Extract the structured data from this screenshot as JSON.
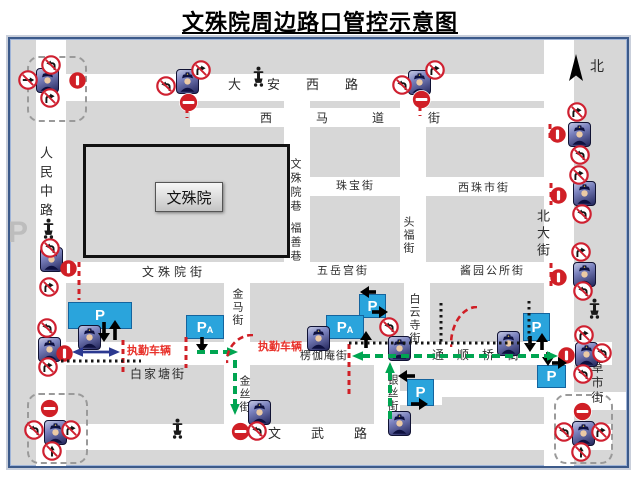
{
  "title": "文殊院周边路口管控示意图",
  "colors": {
    "road": "#ffffff",
    "block": "#d7d7d7",
    "prohibit_red": "#d01f26",
    "sign_ring_red": "#cf2030",
    "parking_blue": "#2aa4dc",
    "route_green": "#00a551",
    "duty_text_red": "#e8312a",
    "escort_blue": "#2b3990",
    "frame_navy": "#3c5a8a"
  },
  "map": {
    "building": {
      "label": "文殊院"
    },
    "north_label": "北",
    "streets": [
      {
        "id": "renmin-zhong-rd",
        "x": 36,
        "y": 40,
        "w": 30,
        "h": 426
      },
      {
        "id": "beida-st",
        "x": 544,
        "y": 40,
        "w": 30,
        "h": 426
      },
      {
        "id": "daan-xi-rd",
        "x": 36,
        "y": 74,
        "w": 538,
        "h": 27
      },
      {
        "id": "ximadao-st",
        "x": 190,
        "y": 108,
        "w": 366,
        "h": 19
      },
      {
        "id": "wenshuyuan-xiang",
        "x": 284,
        "y": 101,
        "w": 26,
        "h": 164
      },
      {
        "id": "toufu-st",
        "x": 400,
        "y": 101,
        "w": 26,
        "h": 164
      },
      {
        "id": "zhubao-xizhushi-st",
        "x": 310,
        "y": 177,
        "w": 235,
        "h": 19
      },
      {
        "id": "wenshuyuan-wuyuegong-jiangyuan-st",
        "x": 36,
        "y": 262,
        "w": 538,
        "h": 21
      },
      {
        "id": "jinma-st",
        "x": 224,
        "y": 283,
        "w": 26,
        "h": 61
      },
      {
        "id": "baiyunsi-st",
        "x": 404,
        "y": 283,
        "w": 26,
        "h": 61
      },
      {
        "id": "baijiatang-tongshunqiao-st",
        "x": 36,
        "y": 342,
        "w": 576,
        "h": 23
      },
      {
        "id": "jinsi-st",
        "x": 224,
        "y": 365,
        "w": 26,
        "h": 61
      },
      {
        "id": "yinsi-st",
        "x": 374,
        "y": 365,
        "w": 26,
        "h": 61
      },
      {
        "id": "wenwu-rd",
        "x": 36,
        "y": 424,
        "w": 576,
        "h": 26
      },
      {
        "id": "side-lane",
        "x": 430,
        "y": 380,
        "w": 114,
        "h": 17
      },
      {
        "id": "side-lane-2",
        "x": 400,
        "y": 391,
        "w": 42,
        "h": 14
      },
      {
        "id": "caoshi-st-stub",
        "x": 574,
        "y": 392,
        "w": 52,
        "h": 18
      }
    ],
    "clusters": [
      {
        "x": 27,
        "y": 56,
        "w": 56,
        "h": 62
      },
      {
        "x": 27,
        "y": 393,
        "w": 57,
        "h": 67
      },
      {
        "x": 554,
        "y": 394,
        "w": 55,
        "h": 66
      }
    ],
    "labels": [
      {
        "t": "人民中路",
        "x": 39,
        "y": 146,
        "v": 1,
        "s": 13,
        "ls": 6
      },
      {
        "t": "大安西路",
        "x": 228,
        "y": 78,
        "s": 13,
        "ls": 26
      },
      {
        "t": "西马道街",
        "x": 260,
        "y": 112,
        "s": 12,
        "ls": 44
      },
      {
        "t": "文殊院巷",
        "x": 289,
        "y": 158,
        "v": 1,
        "s": 11,
        "ls": 3
      },
      {
        "t": "福善巷",
        "x": 289,
        "y": 222,
        "v": 1,
        "s": 11,
        "ls": 3
      },
      {
        "t": "珠宝街",
        "x": 336,
        "y": 181,
        "s": 11,
        "ls": 2
      },
      {
        "t": "西珠市街",
        "x": 458,
        "y": 183,
        "s": 11,
        "ls": 2
      },
      {
        "t": "头福街",
        "x": 402,
        "y": 216,
        "v": 1,
        "s": 11,
        "ls": 2
      },
      {
        "t": "北大街",
        "x": 536,
        "y": 209,
        "v": 1,
        "s": 13,
        "ls": 4
      },
      {
        "t": "北",
        "x": 590,
        "y": 61,
        "s": 14,
        "name": "north-label"
      },
      {
        "t": "文殊院街",
        "x": 142,
        "y": 266,
        "s": 12,
        "ls": 4
      },
      {
        "t": "五岳宫街",
        "x": 317,
        "y": 266,
        "s": 11,
        "ls": 2
      },
      {
        "t": "酱园公所街",
        "x": 460,
        "y": 266,
        "s": 11,
        "ls": 2
      },
      {
        "t": "金马街",
        "x": 231,
        "y": 288,
        "v": 1,
        "s": 11,
        "ls": 2
      },
      {
        "t": "白云寺街",
        "x": 408,
        "y": 293,
        "v": 1,
        "s": 11,
        "ls": 2
      },
      {
        "t": "执勤车辆",
        "x": 127,
        "y": 346,
        "s": 11,
        "c": "#e8312a",
        "b": 1,
        "name": "duty-vehicle-label"
      },
      {
        "t": "执勤车辆",
        "x": 258,
        "y": 342,
        "s": 11,
        "c": "#e8312a",
        "b": 1,
        "name": "duty-vehicle-label"
      },
      {
        "t": "楞伽庵街",
        "x": 300,
        "y": 351,
        "s": 11,
        "ls": 1
      },
      {
        "t": "白家塘街",
        "x": 130,
        "y": 368,
        "s": 12,
        "ls": 2
      },
      {
        "t": "通顺桥街",
        "x": 432,
        "y": 349,
        "s": 12,
        "ls": 13
      },
      {
        "t": "金丝街",
        "x": 238,
        "y": 375,
        "v": 1,
        "s": 11,
        "ls": 2
      },
      {
        "t": "银丝街",
        "x": 386,
        "y": 374,
        "v": 1,
        "s": 11,
        "ls": 2
      },
      {
        "t": "草市街",
        "x": 591,
        "y": 361,
        "v": 1,
        "s": 12,
        "ls": 3
      },
      {
        "t": "文武路",
        "x": 268,
        "y": 427,
        "s": 13,
        "ls": 30
      },
      {
        "t": "P",
        "x": 8,
        "y": 218,
        "s": 30,
        "c": "#bdbdbd",
        "b": 1,
        "f": "sans",
        "name": "parking-watermark"
      }
    ],
    "markers": [
      {
        "t": "police-icon",
        "x": 46,
        "y": 79
      },
      {
        "t": "police-icon",
        "x": 186,
        "y": 80
      },
      {
        "t": "police-icon",
        "x": 418,
        "y": 81
      },
      {
        "t": "police-icon",
        "x": 578,
        "y": 133
      },
      {
        "t": "police-icon",
        "x": 583,
        "y": 192
      },
      {
        "t": "police-icon",
        "x": 583,
        "y": 273
      },
      {
        "t": "police-icon",
        "x": 50,
        "y": 258
      },
      {
        "t": "police-icon",
        "x": 88,
        "y": 336
      },
      {
        "t": "police-icon",
        "x": 48,
        "y": 348
      },
      {
        "t": "police-icon",
        "x": 317,
        "y": 337
      },
      {
        "t": "police-icon",
        "x": 398,
        "y": 347
      },
      {
        "t": "police-icon",
        "x": 507,
        "y": 342
      },
      {
        "t": "police-icon",
        "x": 585,
        "y": 353
      },
      {
        "t": "police-icon",
        "x": 258,
        "y": 411
      },
      {
        "t": "police-icon",
        "x": 398,
        "y": 422
      },
      {
        "t": "police-icon",
        "x": 54,
        "y": 431
      },
      {
        "t": "police-icon",
        "x": 582,
        "y": 432
      },
      {
        "t": "checkpoint-sign",
        "x": 77,
        "y": 80
      },
      {
        "t": "checkpoint-sign",
        "x": 68,
        "y": 268
      },
      {
        "t": "checkpoint-sign",
        "x": 64,
        "y": 353
      },
      {
        "t": "checkpoint-sign",
        "x": 557,
        "y": 134
      },
      {
        "t": "checkpoint-sign",
        "x": 558,
        "y": 195
      },
      {
        "t": "checkpoint-sign",
        "x": 558,
        "y": 277
      },
      {
        "t": "checkpoint-sign",
        "x": 566,
        "y": 355
      },
      {
        "t": "no-entry-sign",
        "x": 188,
        "y": 102
      },
      {
        "t": "no-entry-sign",
        "x": 421,
        "y": 99
      },
      {
        "t": "no-entry-sign",
        "x": 49,
        "y": 408
      },
      {
        "t": "no-entry-sign",
        "x": 240,
        "y": 431
      },
      {
        "t": "no-entry-sign",
        "x": 582,
        "y": 411
      },
      {
        "t": "no-left-turn-sign",
        "x": 51,
        "y": 65
      },
      {
        "t": "no-left-turn-sign",
        "x": 166,
        "y": 86
      },
      {
        "t": "no-left-turn-sign",
        "x": 402,
        "y": 85
      },
      {
        "t": "no-left-turn-sign",
        "x": 580,
        "y": 155
      },
      {
        "t": "no-left-turn-sign",
        "x": 582,
        "y": 214
      },
      {
        "t": "no-left-turn-sign",
        "x": 583,
        "y": 291
      },
      {
        "t": "no-left-turn-sign",
        "x": 50,
        "y": 248
      },
      {
        "t": "no-left-turn-sign",
        "x": 47,
        "y": 328
      },
      {
        "t": "no-left-turn-sign",
        "x": 34,
        "y": 430
      },
      {
        "t": "no-left-turn-sign",
        "x": 564,
        "y": 432
      },
      {
        "t": "no-left-turn-sign",
        "x": 389,
        "y": 327
      },
      {
        "t": "no-left-turn-sign",
        "x": 583,
        "y": 374
      },
      {
        "t": "no-left-turn-sign",
        "x": 257,
        "y": 431
      },
      {
        "t": "no-left-turn-sign",
        "x": 602,
        "y": 353
      },
      {
        "t": "no-right-turn-sign",
        "x": 50,
        "y": 98
      },
      {
        "t": "no-right-turn-sign",
        "x": 201,
        "y": 70
      },
      {
        "t": "no-right-turn-sign",
        "x": 435,
        "y": 70
      },
      {
        "t": "no-right-turn-sign",
        "x": 577,
        "y": 112
      },
      {
        "t": "no-right-turn-sign",
        "x": 579,
        "y": 175
      },
      {
        "t": "no-right-turn-sign",
        "x": 581,
        "y": 252
      },
      {
        "t": "no-right-turn-sign",
        "x": 49,
        "y": 287
      },
      {
        "t": "no-right-turn-sign",
        "x": 48,
        "y": 367
      },
      {
        "t": "no-right-turn-sign",
        "x": 71,
        "y": 430
      },
      {
        "t": "no-right-turn-sign",
        "x": 601,
        "y": 432
      },
      {
        "t": "no-right-turn-sign",
        "x": 584,
        "y": 335
      },
      {
        "t": "no-straight-sign",
        "x": 52,
        "y": 451
      },
      {
        "t": "no-straight-sign",
        "x": 581,
        "y": 452
      },
      {
        "t": "no-through-sign",
        "x": 28,
        "y": 80
      },
      {
        "t": "motorcycle-icon",
        "x": 258,
        "y": 76
      },
      {
        "t": "motorcycle-icon",
        "x": 48,
        "y": 228
      },
      {
        "t": "motorcycle-icon",
        "x": 594,
        "y": 308
      },
      {
        "t": "motorcycle-icon",
        "x": 177,
        "y": 428
      },
      {
        "t": "north-arrow-icon",
        "x": 576,
        "y": 70
      }
    ],
    "arrows": [
      {
        "x": 98,
        "y": 322,
        "d": "down",
        "l": 20
      },
      {
        "x": 109,
        "y": 320,
        "d": "up",
        "l": 20
      },
      {
        "x": 196,
        "y": 337,
        "d": "down",
        "l": 16
      },
      {
        "x": 360,
        "y": 331,
        "d": "up",
        "l": 17
      },
      {
        "x": 360,
        "y": 286,
        "d": "left",
        "l": 16
      },
      {
        "x": 372,
        "y": 306,
        "d": "right",
        "l": 16
      },
      {
        "x": 524,
        "y": 336,
        "d": "down",
        "l": 16
      },
      {
        "x": 536,
        "y": 333,
        "d": "up",
        "l": 17
      },
      {
        "x": 542,
        "y": 352,
        "d": "down",
        "l": 14
      },
      {
        "x": 398,
        "y": 370,
        "d": "left",
        "l": 17
      },
      {
        "x": 411,
        "y": 398,
        "d": "right",
        "l": 17
      },
      {
        "x": 552,
        "y": 357,
        "d": "right",
        "l": 15
      }
    ],
    "lines": [
      {
        "k": "red",
        "o": "v",
        "x": 187,
        "y": 107,
        "l": 12
      },
      {
        "k": "red",
        "o": "v",
        "x": 420,
        "y": 105,
        "l": 12
      },
      {
        "k": "red",
        "o": "v",
        "x": 550,
        "y": 123,
        "l": 20
      },
      {
        "k": "red",
        "o": "v",
        "x": 551,
        "y": 182,
        "l": 24
      },
      {
        "k": "red",
        "o": "v",
        "x": 551,
        "y": 262,
        "l": 27
      },
      {
        "k": "red",
        "o": "v",
        "x": 79,
        "y": 261,
        "l": 40
      },
      {
        "k": "red",
        "o": "v",
        "x": 123,
        "y": 339,
        "l": 34
      },
      {
        "k": "red",
        "o": "v",
        "x": 186,
        "y": 336,
        "l": 33
      },
      {
        "k": "red",
        "o": "v",
        "x": 349,
        "y": 343,
        "l": 56
      },
      {
        "k": "green",
        "o": "h",
        "x": 196,
        "y": 352,
        "l": 42,
        "he": 1
      },
      {
        "k": "green",
        "o": "v",
        "x": 235,
        "y": 359,
        "l": 56,
        "he": 1
      },
      {
        "k": "green",
        "o": "h",
        "x": 352,
        "y": 356,
        "l": 206,
        "hs": 1,
        "he": 1
      },
      {
        "k": "green",
        "o": "v",
        "x": 390,
        "y": 362,
        "l": 62,
        "hs": 1
      },
      {
        "k": "dot",
        "o": "h",
        "x": 60,
        "y": 361,
        "l": 82
      },
      {
        "k": "dot",
        "o": "h",
        "x": 348,
        "y": 343,
        "l": 176
      },
      {
        "k": "dot",
        "o": "v",
        "x": 441,
        "y": 302,
        "l": 42
      },
      {
        "k": "dot",
        "o": "v",
        "x": 529,
        "y": 300,
        "l": 46
      },
      {
        "k": "blue",
        "o": "h",
        "x": 72,
        "y": 352,
        "l": 48,
        "hs": 1,
        "he": 1
      }
    ],
    "arcs": [
      {
        "x": 226,
        "y": 334,
        "w": 30,
        "h": 30
      },
      {
        "x": 450,
        "y": 306,
        "w": 30,
        "h": 42
      }
    ],
    "parkings": [
      {
        "x": 68,
        "y": 302,
        "w": 62,
        "h": 25,
        "label": "P"
      },
      {
        "x": 186,
        "y": 315,
        "w": 36,
        "h": 22,
        "label": "P",
        "sub": "A"
      },
      {
        "x": 359,
        "y": 294,
        "w": 25,
        "h": 22,
        "label": "P"
      },
      {
        "x": 326,
        "y": 315,
        "w": 36,
        "h": 22,
        "label": "P",
        "sub": "A"
      },
      {
        "x": 523,
        "y": 313,
        "w": 25,
        "h": 26,
        "label": "P"
      },
      {
        "x": 537,
        "y": 365,
        "w": 27,
        "h": 21,
        "label": "P"
      },
      {
        "x": 407,
        "y": 379,
        "w": 25,
        "h": 25,
        "label": "P"
      }
    ]
  }
}
